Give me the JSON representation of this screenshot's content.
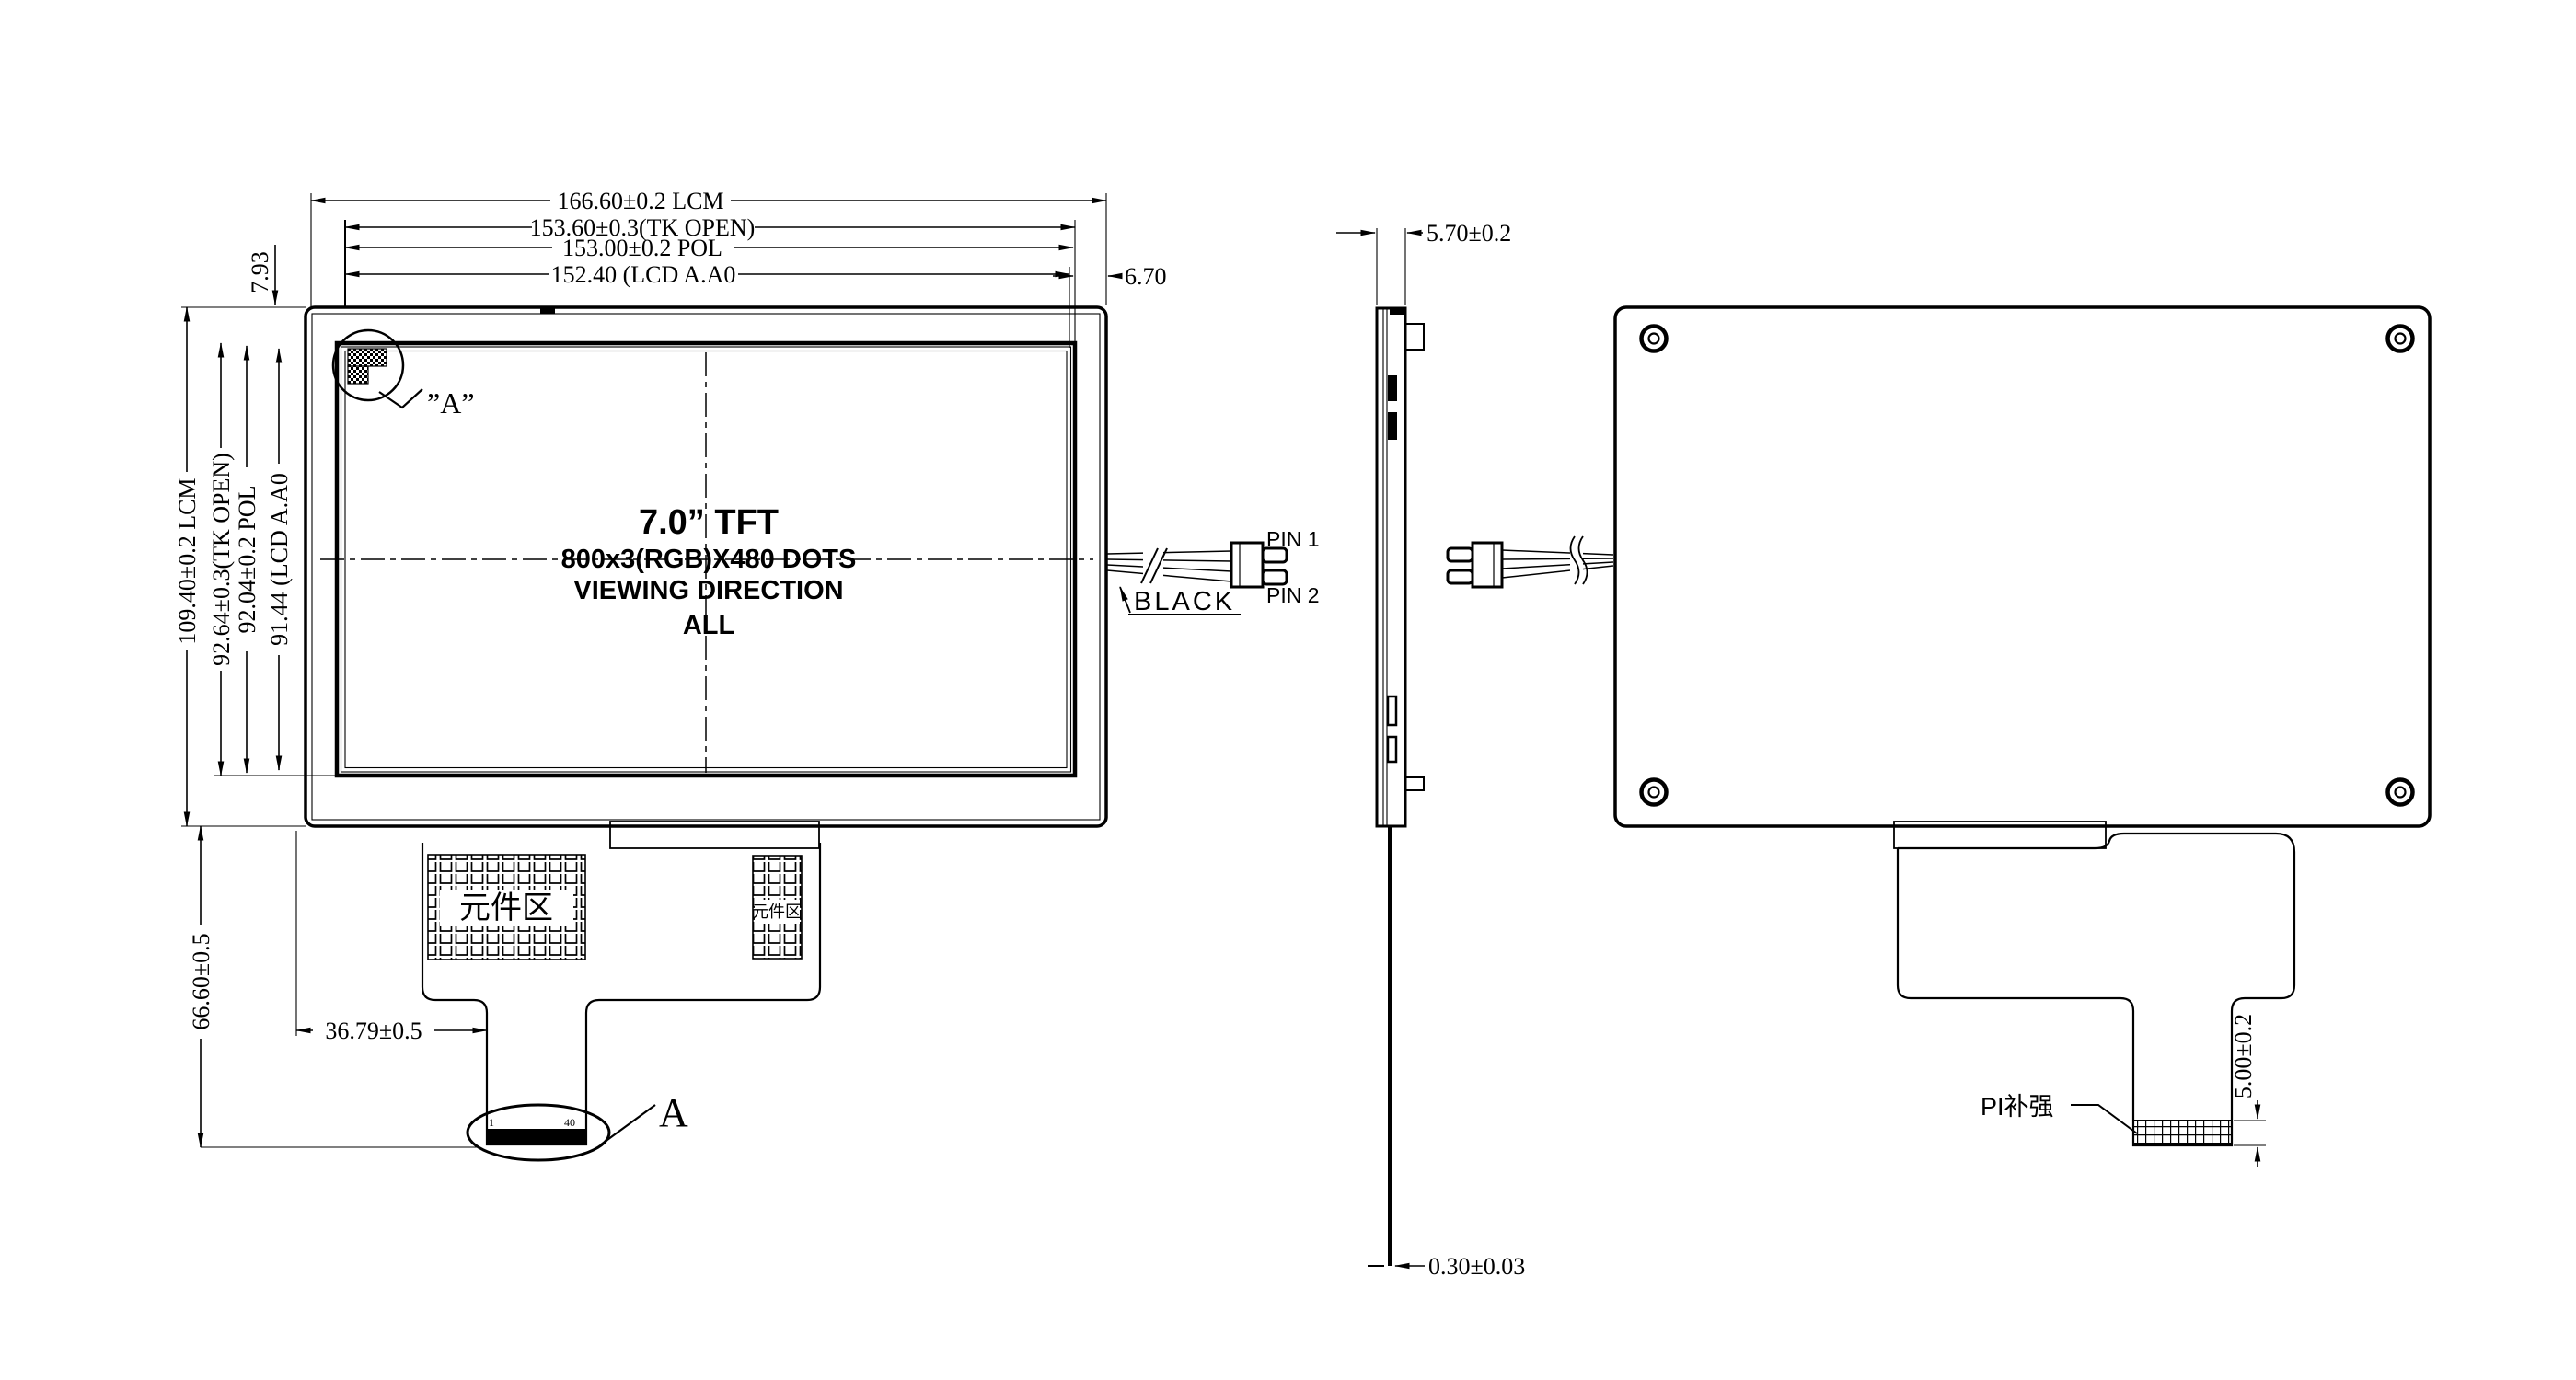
{
  "colors": {
    "ink": "#000000",
    "paper": "#ffffff"
  },
  "front": {
    "dim_width_lcm": "166.60±0.2 LCM",
    "dim_width_tk": "153.60±0.3(TK OPEN)",
    "dim_width_pol": "153.00±0.2 POL",
    "dim_width_aa": "152.40 (LCD A.A0",
    "dim_right_gap": "6.70",
    "dim_top_gap": "7.93",
    "dim_height_lcm": "109.40±0.2 LCM",
    "dim_height_tk": "92.64±0.3(TK OPEN)",
    "dim_height_pol": "92.04±0.2 POL",
    "dim_height_aa": "91.44 (LCD A.A0",
    "dim_fpc_length": "66.60±0.5",
    "dim_tail_offset": "36.79±0.5",
    "panel_size": "7.0” TFT",
    "resolution": "800x3(RGB)X480 DOTS",
    "viewing": "VIEWING DIRECTION",
    "viewing_value": "ALL",
    "detail_ref": "”A”",
    "component_area": "元件区",
    "component_area_small": "元件区",
    "wire_color": "BLACK",
    "pin1": "PIN 1",
    "pin2": "PIN 2",
    "pad_first": "1",
    "pad_last": "40",
    "detail_name": "A"
  },
  "side": {
    "dim_thickness": "5.70±0.2",
    "dim_fpc": "0.30±0.03"
  },
  "back": {
    "stiffener": "PI补强",
    "dim_tail_width": "5.00±0.2"
  }
}
